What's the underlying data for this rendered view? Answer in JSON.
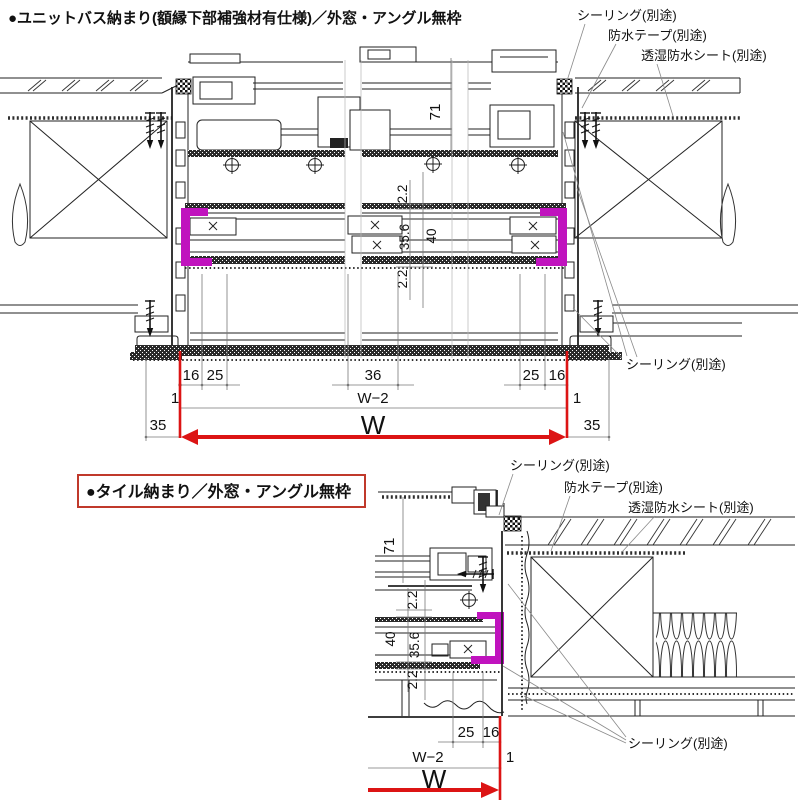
{
  "colors": {
    "red": "#dc1414",
    "magenta": "#c013be",
    "line": "#222222"
  },
  "sections": {
    "top": {
      "title": "●ユニットバス納まり(額縁下部補強材有仕様)／外窓・アングル無枠",
      "labels": {
        "sealing_top": "シーリング(別途)",
        "tape": "防水テープ(別途)",
        "sheet": "透湿防水シート(別途)",
        "sealing_bottom": "シーリング(別途)"
      },
      "dims": {
        "h71": "71",
        "g22t": "2.2",
        "g356": "35.6",
        "g40": "40",
        "g22b": "2.2",
        "b16l": "16",
        "b25l": "25",
        "b36": "36",
        "b25r": "25",
        "b16r": "16",
        "e1l": "1",
        "w2": "W−2",
        "e1r": "1",
        "m35l": "35",
        "w": "W",
        "m35r": "35"
      }
    },
    "bottom": {
      "title": "●タイル納まり／外窓・アングル無枠",
      "labels": {
        "sealing_top": "シーリング(別途)",
        "tape": "防水テープ(別途)",
        "sheet": "透湿防水シート(別途)",
        "sealing_bottom": "シーリング(別途)"
      },
      "dims": {
        "h71": "71",
        "g22t": "2.2",
        "g356": "35.6",
        "g40": "40",
        "g22b": "2.2",
        "b25": "25",
        "b16": "16",
        "w2": "W−2",
        "e1": "1",
        "w": "W"
      }
    }
  }
}
